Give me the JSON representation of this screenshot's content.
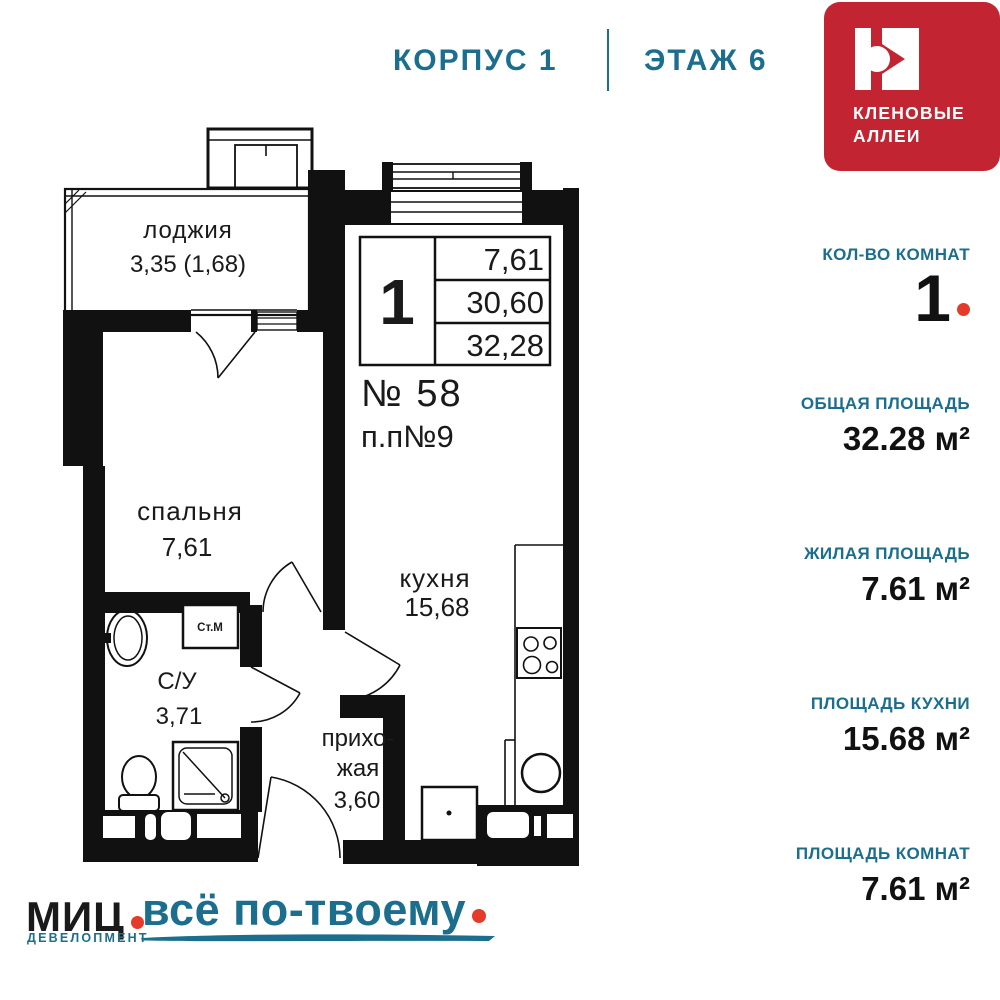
{
  "header": {
    "building_label": "КОРПУС 1",
    "floor_label": "ЭТАЖ 6"
  },
  "brand": {
    "name_line1": "КЛЕНОВЫЕ",
    "name_line2": "АЛЛЕИ"
  },
  "plan": {
    "stamp": {
      "rooms": "1",
      "row1": "7,61",
      "row2": "30,60",
      "row3": "32,28"
    },
    "apartment_number": "№ 58",
    "pp_number": "п.п№9",
    "rooms": {
      "loggia": {
        "name": "лоджия",
        "area": "3,35 (1,68)"
      },
      "bedroom": {
        "name": "спальня",
        "area": "7,61"
      },
      "bathroom": {
        "name": "С/У",
        "area": "3,71"
      },
      "hallway": {
        "name_line1": "прихо-",
        "name_line2": "жая",
        "area": "3,60"
      },
      "kitchen": {
        "name": "кухня",
        "area": "15,68"
      }
    },
    "washer_label": "Ст.М"
  },
  "sidebar": {
    "blocks": [
      {
        "label": "КОЛ-ВО КОМНАТ",
        "value": "1"
      },
      {
        "label": "ОБЩАЯ ПЛОЩАДЬ",
        "value": "32.28 м²"
      },
      {
        "label": "ЖИЛАЯ ПЛОЩАДЬ",
        "value": "7.61 м²"
      },
      {
        "label": "ПЛОЩАДЬ КУХНИ",
        "value": "15.68 м²"
      },
      {
        "label": "ПЛОЩАДЬ КОМНАТ",
        "value": "7.61 м²"
      }
    ]
  },
  "footer": {
    "developer_name": "МИЦ",
    "developer_sub": "ДЕВЕЛОПМЕНТ",
    "slogan": "всё по-твоему"
  },
  "colors": {
    "teal": "#1b6e8d",
    "logo_red": "#c32431",
    "accent_red": "#e43b2a",
    "ink": "#111111"
  }
}
